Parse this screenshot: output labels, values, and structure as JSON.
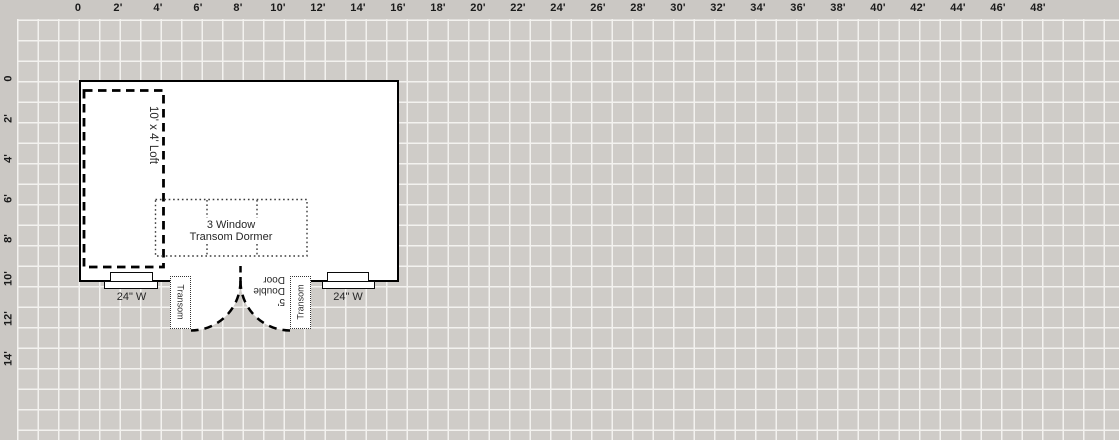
{
  "app": {
    "view": "floor-plan-designer-canvas"
  },
  "colors": {
    "grid_bg": "#cfccc8",
    "grid_line": "#f3f2ef",
    "ruler_bg": "#cbc8c4",
    "wall": "#000000",
    "element_fill": "#ffffff",
    "ink": "#1a1a1a",
    "annotation_text": "#262626"
  },
  "rulers": {
    "top": {
      "labels": [
        "0",
        "2'",
        "4'",
        "6'",
        "8'",
        "10'",
        "12'",
        "14'",
        "16'",
        "18'",
        "20'",
        "22'",
        "24'",
        "26'",
        "28'",
        "30'",
        "32'",
        "34'",
        "36'",
        "38'",
        "40'",
        "42'",
        "44'",
        "46'",
        "48'"
      ]
    },
    "left": {
      "labels": [
        "0",
        "2'",
        "4'",
        "6'",
        "8'",
        "10'",
        "12'",
        "14'"
      ]
    }
  },
  "plan": {
    "loft": {
      "label": "10' x 4' Loft"
    },
    "dormer": {
      "line1": "3 Window",
      "line2": "Transom Dormer"
    },
    "window_left": {
      "label": "24\" W"
    },
    "window_right": {
      "label": "24\" W"
    },
    "transom_left": {
      "label": "Transom"
    },
    "transom_right": {
      "label": "Transom"
    },
    "door": {
      "line1": "5'",
      "line2": "Double",
      "line3": "Door"
    }
  }
}
